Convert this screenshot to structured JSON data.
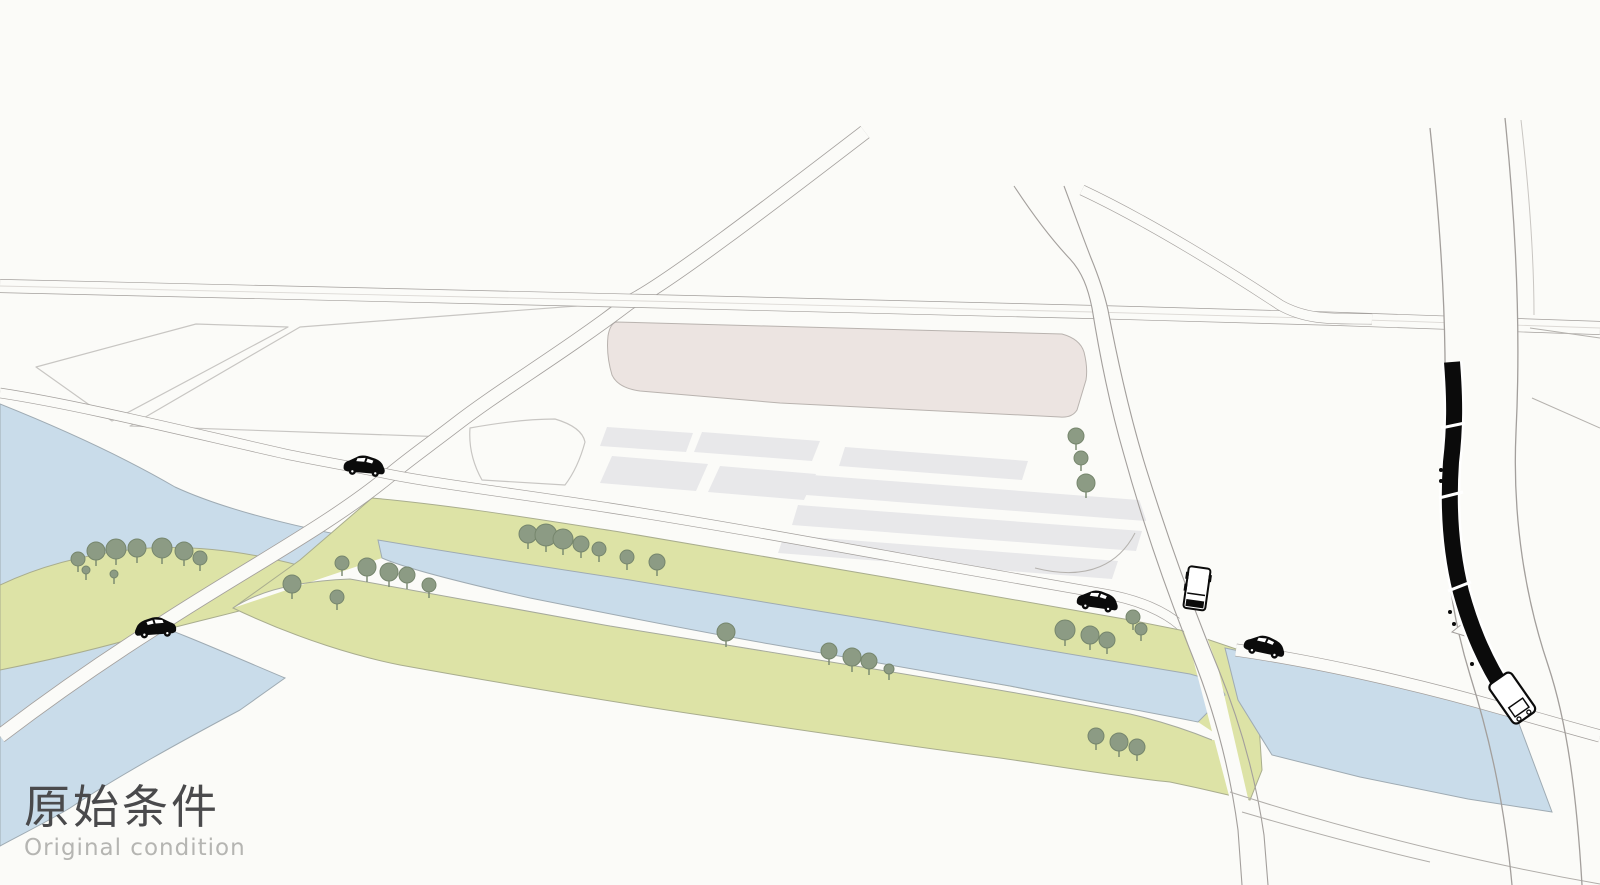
{
  "title": {
    "zh": "原始条件",
    "en": "Original condition"
  },
  "palette": {
    "background": "#fbfbf8",
    "water": "#c9dcea",
    "water_edge": "#9fabb3",
    "greenway": "#dde3a6",
    "greenway_edge": "#a9ad8e",
    "site_pink": "#ece4e1",
    "plot_gray": "#e8e8ea",
    "tree_fill": "#8c9b84",
    "tree_edge": "#76866d",
    "road_line": "#a39f9c",
    "parcel_line": "#c8c6c3",
    "vehicle_black": "#0b0b0b",
    "title_zh_color": "#4a4a4c",
    "title_en_color": "#b5b5b2"
  },
  "inventory": {
    "tree_count": 39,
    "car_count": 4,
    "truck_count": 1,
    "train_count": 1,
    "train_car_count": 4
  },
  "trees": [
    [
      78,
      559,
      7
    ],
    [
      96,
      551,
      9
    ],
    [
      116,
      549,
      10
    ],
    [
      137,
      548,
      9
    ],
    [
      162,
      548,
      10
    ],
    [
      184,
      551,
      9
    ],
    [
      200,
      558,
      7
    ],
    [
      86,
      570,
      4
    ],
    [
      114,
      574,
      4
    ],
    [
      342,
      563,
      7
    ],
    [
      367,
      567,
      9
    ],
    [
      389,
      572,
      9
    ],
    [
      407,
      575,
      8
    ],
    [
      429,
      585,
      7
    ],
    [
      292,
      584,
      9
    ],
    [
      337,
      597,
      7
    ],
    [
      528,
      534,
      9
    ],
    [
      546,
      535,
      11
    ],
    [
      563,
      539,
      10
    ],
    [
      581,
      544,
      8
    ],
    [
      599,
      549,
      7
    ],
    [
      627,
      557,
      7
    ],
    [
      657,
      562,
      8
    ],
    [
      726,
      632,
      9
    ],
    [
      829,
      651,
      8
    ],
    [
      852,
      657,
      9
    ],
    [
      869,
      661,
      8
    ],
    [
      889,
      669,
      5
    ],
    [
      1065,
      630,
      10
    ],
    [
      1090,
      635,
      9
    ],
    [
      1107,
      640,
      8
    ],
    [
      1133,
      617,
      7
    ],
    [
      1141,
      629,
      6
    ],
    [
      1076,
      436,
      8
    ],
    [
      1081,
      458,
      7
    ],
    [
      1086,
      483,
      9
    ],
    [
      1096,
      736,
      8
    ],
    [
      1119,
      742,
      9
    ],
    [
      1137,
      747,
      8
    ]
  ],
  "vehicles": [
    {
      "kind": "car",
      "name": "car-west-riverside",
      "x": 344,
      "y": 452,
      "rot": 5,
      "flip": false
    },
    {
      "kind": "car",
      "name": "car-southwest-bridge",
      "x": 176,
      "y": 614,
      "rot": -4,
      "flip": true
    },
    {
      "kind": "car",
      "name": "car-east-riverside",
      "x": 1078,
      "y": 586,
      "rot": 8,
      "flip": false
    },
    {
      "kind": "car",
      "name": "car-east-branch",
      "x": 1246,
      "y": 630,
      "rot": 12,
      "flip": false
    },
    {
      "kind": "truck",
      "name": "truck-vertical-road",
      "x": 1189,
      "y": 566,
      "rot": 8,
      "flip": false
    }
  ]
}
